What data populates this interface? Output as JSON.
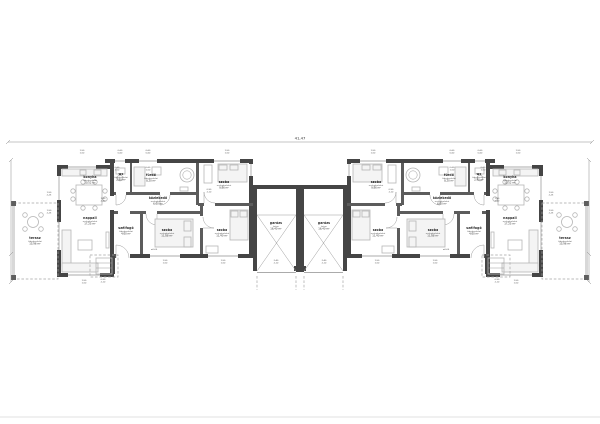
{
  "sheet": {
    "total_dimension": "41,47",
    "wall_color": "#454545",
    "background": "#ffffff"
  },
  "rooms": [
    {
      "id": "konyha",
      "name": "konyha",
      "floor": "hidegburkolat",
      "area": "10,52 m²",
      "cx": 90,
      "cy": 178
    },
    {
      "id": "wc",
      "name": "wc",
      "floor": "hidegburkolat",
      "area": "2,90 m²",
      "cx": 121,
      "cy": 175
    },
    {
      "id": "furdo",
      "name": "fürdő",
      "floor": "hidegburkolat",
      "area": "8,20 m²",
      "cx": 151,
      "cy": 176
    },
    {
      "id": "szoba-eszaki",
      "name": "szoba",
      "floor": "melegburkolat",
      "area": "9,86 m²",
      "cx": 224,
      "cy": 183
    },
    {
      "id": "kozlekedo",
      "name": "közlekedő",
      "floor": "melegburkolat",
      "area": "6,60 m²",
      "cx": 158,
      "cy": 199
    },
    {
      "id": "nappali",
      "name": "nappali",
      "floor": "melegburkolat",
      "area": "17,25 m²",
      "cx": 90,
      "cy": 219
    },
    {
      "id": "szelfogo",
      "name": "szélfogó",
      "floor": "hidegburkolat",
      "area": "4,60 m²",
      "cx": 126,
      "cy": 229
    },
    {
      "id": "szoba-kozepso",
      "name": "szoba",
      "floor": "melegburkolat",
      "area": "11,88 m²",
      "cx": 167,
      "cy": 231
    },
    {
      "id": "szoba-deli",
      "name": "szoba",
      "floor": "melegburkolat",
      "area": "11,40 m²",
      "cx": 222,
      "cy": 231
    },
    {
      "id": "garazs",
      "name": "garázs",
      "floor": "beton",
      "area": "16,40 m²",
      "cx": 276,
      "cy": 224
    },
    {
      "id": "terasz",
      "name": "terasz",
      "floor": "hidegburkolat",
      "area": "15,96 m²",
      "cx": 35,
      "cy": 239
    }
  ],
  "markers": [
    {
      "top": "1,50",
      "bottom": "1,50",
      "x": 82,
      "y": 151
    },
    {
      "top": "0,60",
      "bottom": "0,60",
      "x": 120,
      "y": 151
    },
    {
      "top": "0,60",
      "bottom": "0,60",
      "x": 148,
      "y": 151
    },
    {
      "top": "1,50",
      "bottom": "1,50",
      "x": 227,
      "y": 151
    },
    {
      "top": "1,50",
      "bottom": "2,25",
      "x": 49,
      "y": 193
    },
    {
      "top": "1,50",
      "bottom": "2,25",
      "x": 49,
      "y": 211
    },
    {
      "top": "0,60",
      "bottom": "1,50",
      "x": 117,
      "y": 168
    },
    {
      "top": "0,60",
      "bottom": "1,50",
      "x": 148,
      "y": 168
    },
    {
      "top": "1,90",
      "bottom": "2,40",
      "x": 103,
      "y": 199
    },
    {
      "top": "0,90",
      "bottom": "2,10",
      "x": 209,
      "y": 190
    },
    {
      "top": "1,50",
      "bottom": "1,50",
      "x": 165,
      "y": 261
    },
    {
      "top": "1,50",
      "bottom": "1,50",
      "x": 223,
      "y": 261
    },
    {
      "top": "1,50",
      "bottom": "1,50",
      "x": 84,
      "y": 281
    },
    {
      "top": "0,90",
      "bottom": "2,10",
      "x": 103,
      "y": 280
    },
    {
      "top": "2,40",
      "bottom": "2,10",
      "x": 276,
      "y": 261
    },
    {
      "top": "±0,00",
      "bottom": "",
      "x": 154,
      "y": 250
    }
  ]
}
